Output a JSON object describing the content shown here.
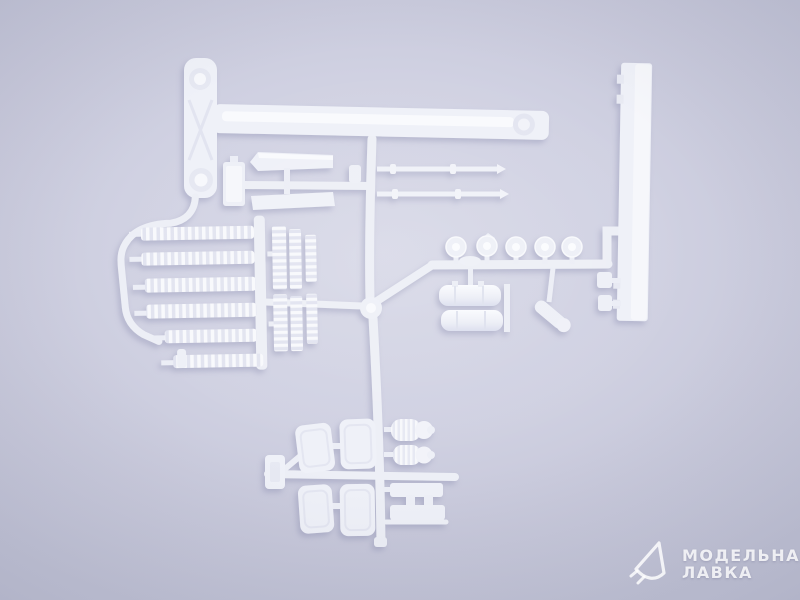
{
  "photo": {
    "kind": "product-photo",
    "subject": "White injection-molded plastic model kit sprue (parts tree) laid on a pale lavender studio background",
    "colors": {
      "background_center": "#d9dae8",
      "background_edge": "#bec0d3",
      "plastic": "#eef0f7",
      "plastic_highlight": "#fafbfd",
      "plastic_recess": "#e3e5f0",
      "runner": "#edeff6",
      "cast_shadow": "#9093b4",
      "watermark_text": "rgba(255,255,255,0.82)"
    },
    "parts": [
      {
        "name": "leaf-spring-plate",
        "desc": "flat plate with round bosses, top left"
      },
      {
        "name": "chassis-beam",
        "desc": "long flat beam across the top with round recess at right end"
      },
      {
        "name": "side-rail",
        "desc": "long vertical flat rail, right side"
      },
      {
        "name": "radiator-box",
        "desc": "small rectangular box"
      },
      {
        "name": "mudguard-upper",
        "desc": "angled flat blade"
      },
      {
        "name": "mudguard-lower",
        "desc": "flat blade"
      },
      {
        "name": "ribbed-rows",
        "desc": "six horizontal rows of small ribbed segments, left cluster"
      },
      {
        "name": "ladder-strips",
        "desc": "short vertical ribbed strips beside the rows"
      },
      {
        "name": "axle-rods",
        "desc": "two thin rods with tips"
      },
      {
        "name": "wheel-hubs",
        "desc": "row of five small round hubs"
      },
      {
        "name": "fuel-tanks",
        "desc": "two stacked horizontal cylinders"
      },
      {
        "name": "angled-cylinder",
        "desc": "small diagonal cylindrical part"
      },
      {
        "name": "tool-boxes",
        "desc": "four rounded rectangular boxes in a 2x2 group"
      },
      {
        "name": "air-filters",
        "desc": "two ribbed cylinders with round caps"
      },
      {
        "name": "step-frame",
        "desc": "ladder-shaped flat part, lower right of box group"
      },
      {
        "name": "sprue-runners",
        "desc": "connecting channels with central round junction"
      }
    ]
  },
  "watermark": {
    "logo": "paper-plane-logo",
    "line1": "МОДЕЛЬНАЯ",
    "line2": "ЛАВКА"
  }
}
